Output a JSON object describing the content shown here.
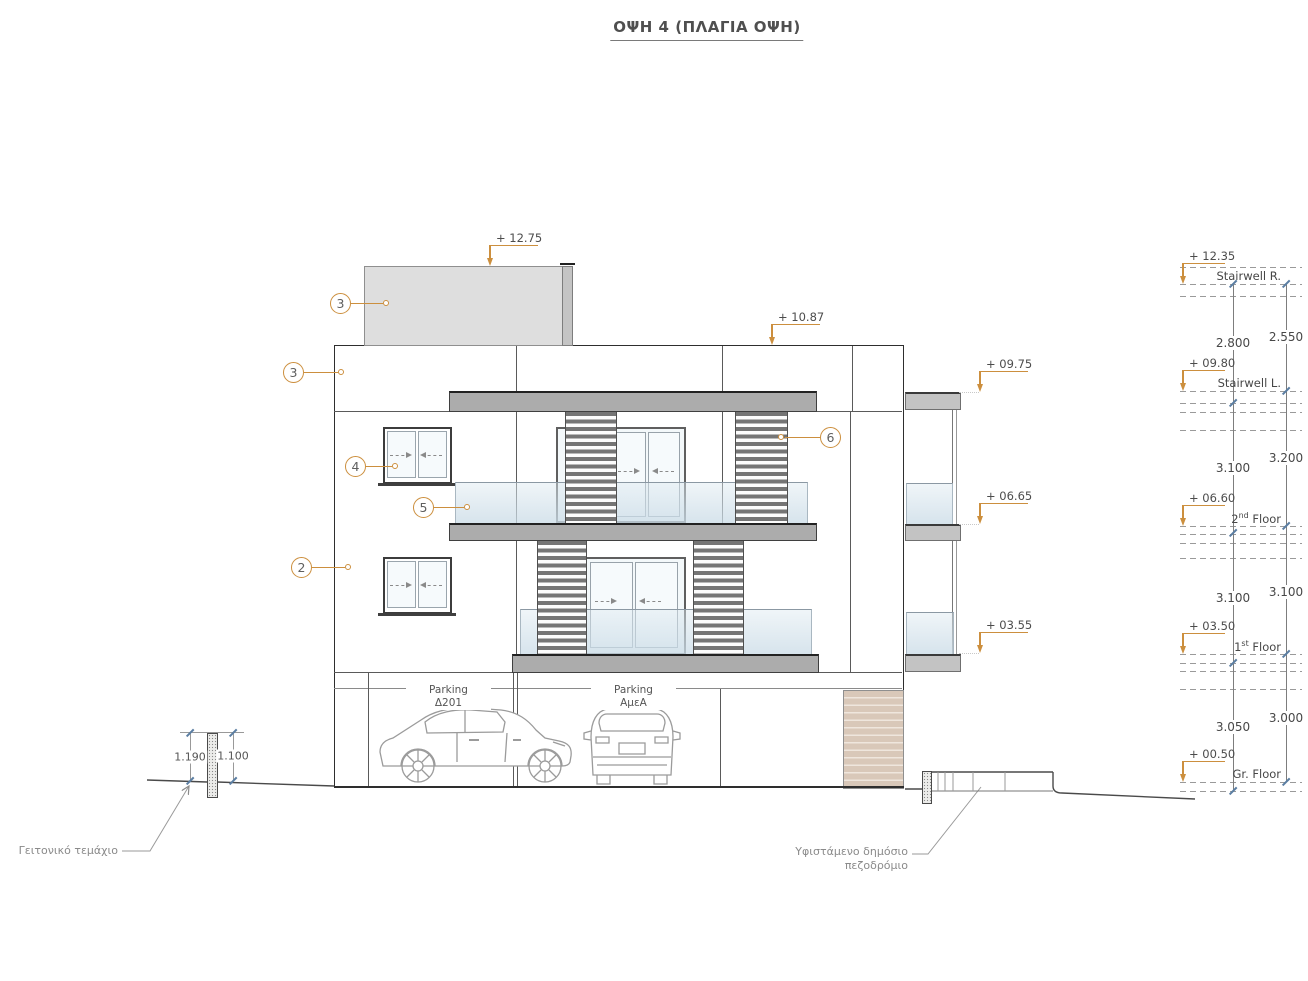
{
  "title": "ΟΨΗ 4 (ΠΛΑΓΙΑ ΟΨΗ)",
  "colors": {
    "accent": "#cc8f3e",
    "line": "#2e2e2e",
    "text": "#4a4a4a"
  },
  "elev_markers": {
    "stairwell_roof": "+ 12.75",
    "main_roof": "+ 10.87",
    "parapet": "+ 09.75",
    "balcony2": "+ 06.65",
    "balcony1": "+ 03.55"
  },
  "levels": [
    {
      "marker": "+ 12.35",
      "label": "Stairwell R."
    },
    {
      "marker": "+ 09.80",
      "label": "Stairwell L."
    },
    {
      "marker": "+ 06.60",
      "num": "2",
      "sup": "nd",
      "rest": " Floor"
    },
    {
      "marker": "+ 03.50",
      "num": "1",
      "sup": "st",
      "rest": " Floor"
    },
    {
      "marker": "+ 00.50",
      "label": "Gr. Floor"
    }
  ],
  "dims_left": [
    "2.800",
    "3.100",
    "3.100",
    "3.050"
  ],
  "dims_right": [
    "2.550",
    "3.200",
    "3.100",
    "3.000"
  ],
  "callouts": {
    "stairwell": "3",
    "parapet": "3",
    "window2f": "4",
    "railing": "5",
    "wall1f": "2",
    "louver": "6"
  },
  "parking": [
    {
      "title": "Parking",
      "code": "Δ201"
    },
    {
      "title": "Parking",
      "code": "ΑμεΑ"
    }
  ],
  "site": {
    "neighbor": "Γειτονικό τεμάχιο",
    "sidewalk1": "Υφιστάμενο δημόσιο",
    "sidewalk2": "πεζοδρόμιο",
    "dim_left": "1.190",
    "dim_right": "1.100"
  }
}
